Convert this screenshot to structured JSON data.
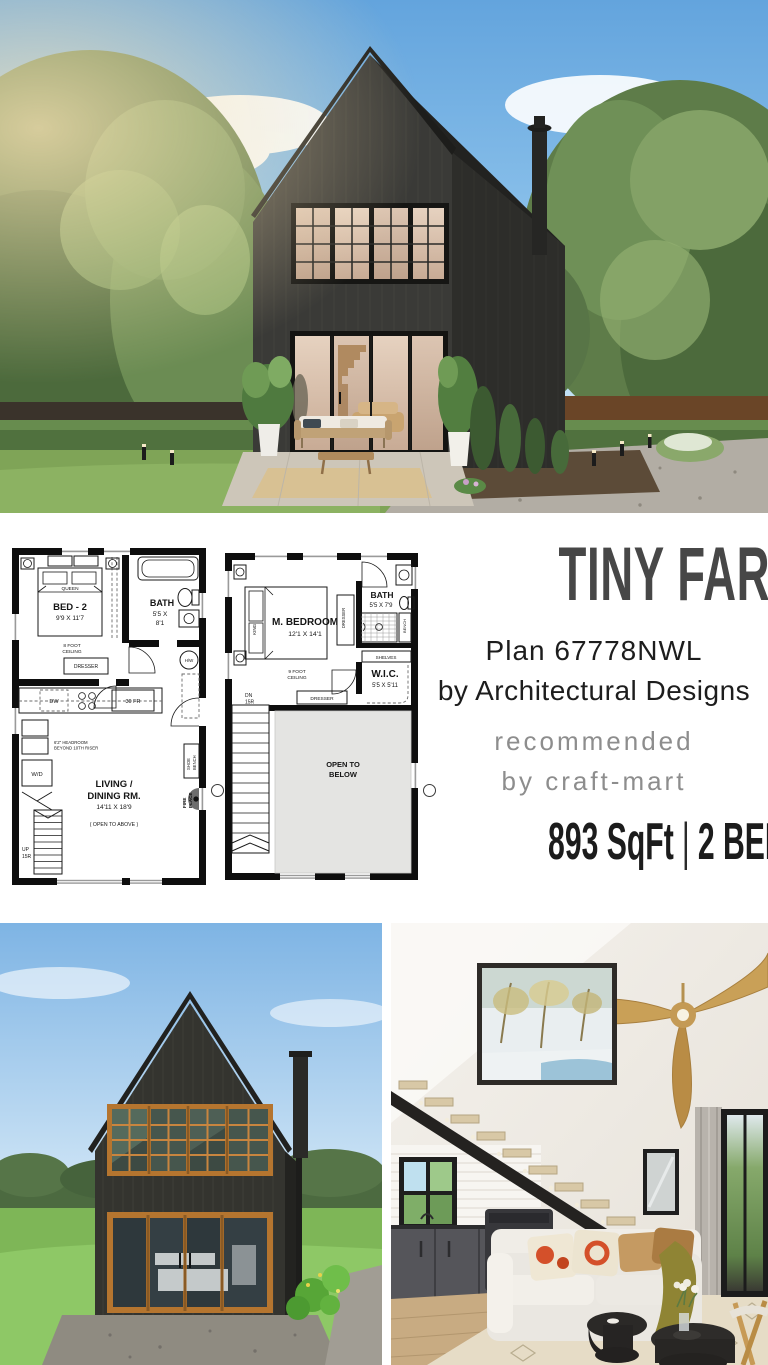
{
  "header": {
    "title": "TINY FARMHOUSE",
    "plan_line": "Plan 67778NWL",
    "byline": "by Architectural Designs",
    "recommended_line1": "recommended",
    "recommended_line2": "by craft-mart",
    "spec_sqft": "893 SqFt",
    "spec_divider": "|",
    "spec_rooms": "2 BED 2 BATH"
  },
  "first_floor": {
    "bed_label": "BED - 2",
    "bed_dims": "9'9 X 11'7",
    "bed_type": "QUEEN",
    "ceiling_l1": "8 FOOT",
    "ceiling_l2": "CEILING",
    "dresser": "DRESSER",
    "bath_label": "BATH",
    "bath_dims_l1": "5'5 X",
    "bath_dims_l2": "8'1",
    "water_heater": "H/W",
    "dishwasher": "DW",
    "fridge": "30 FR",
    "washer_dryer": "W/D",
    "headroom_l1": "6'2\" HEADROOM",
    "headroom_l2": "BEYOND 10TH RISER",
    "living_l1": "LIVING /",
    "living_l2": "DINING RM.",
    "living_dims": "14'11 X 18'9",
    "living_note": "( OPEN TO ABOVE )",
    "shoe_bench_l1": "SHOE",
    "shoe_bench_l2": "BENCH",
    "fireplace_l1": "FIRE",
    "fireplace_l2": "PLACE",
    "stairs_l1": "UP",
    "stairs_l2": "15R"
  },
  "second_floor": {
    "bedroom_label": "M. BEDROOM",
    "bedroom_dims": "12'1 X 14'1",
    "bed_type": "KING",
    "ceiling_l1": "9 FOOT",
    "ceiling_l2": "CEILING",
    "dresser_side": "DRESSER",
    "dresser_bottom": "DRESSER",
    "bath_label": "BATH",
    "bath_dims": "5'5 X 7'9",
    "bench": "BENCH",
    "shelves": "SHELVES",
    "wic_label": "W.I.C.",
    "wic_dims": "5'5 X 5'11",
    "stairs_l1": "DN",
    "stairs_l2": "15R",
    "open_l1": "OPEN TO",
    "open_l2": "BELOW"
  },
  "colors": {
    "title_gray": "#474747",
    "muted_gray": "#8d8d8d",
    "ink": "#1c1c1c",
    "siding_dark": "#3a3a37",
    "wood_frame_accent": "#c8853f",
    "sky_blue": "#8fc4ec",
    "grass_green": "#7fb457"
  }
}
